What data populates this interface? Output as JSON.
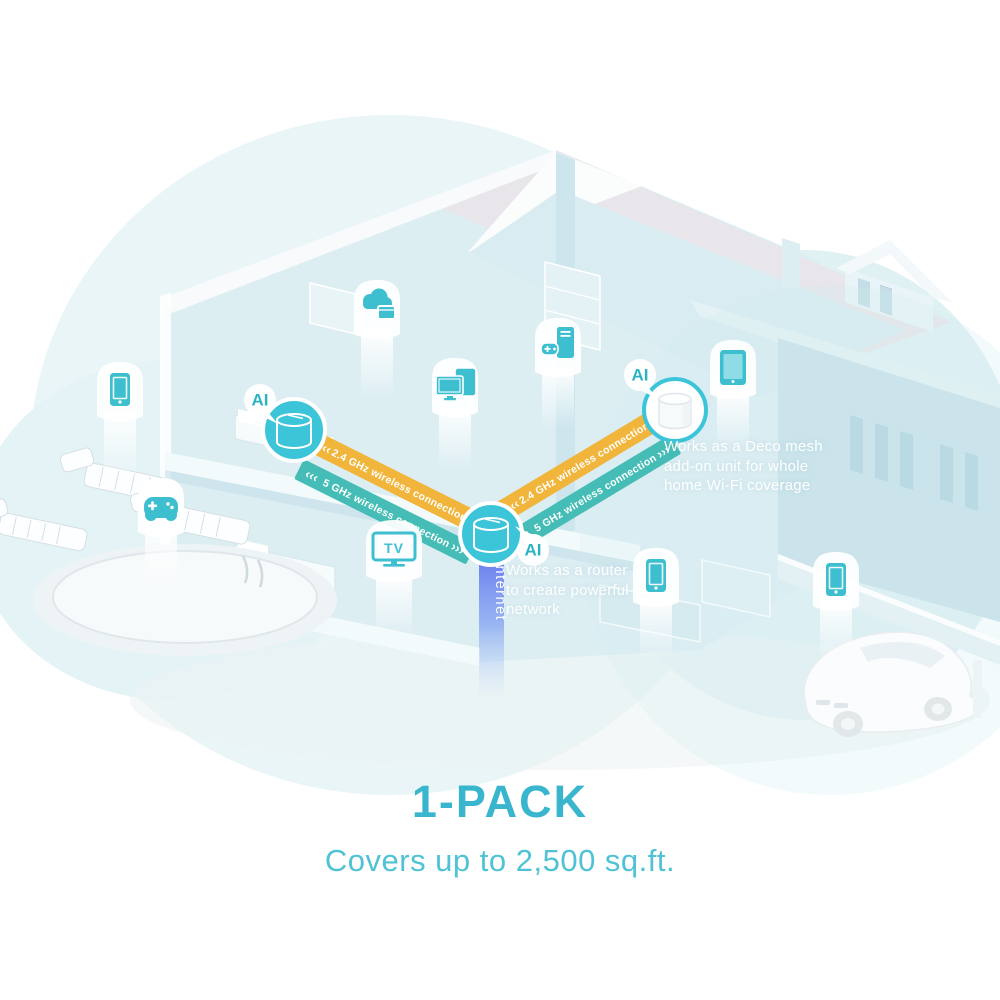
{
  "captions": {
    "pack": "1-PACK",
    "coverage": "Covers up to 2,500 sq.ft."
  },
  "labels": {
    "ai": "AI",
    "internet": "Internet",
    "tv": "TV"
  },
  "annotations": {
    "router_note": "Works as a router\nto create powerful\nnetwork",
    "mesh_note": "Works as a Deco mesh\nadd-on unit for whole\nhome Wi-Fi coverage"
  },
  "connections": {
    "left_24": "2.4 GHz wireless connection",
    "left_5": "5 GHz wireless connection",
    "right_24": "2.4 GHz wireless connection",
    "right_5": "5 GHz wireless connection",
    "chevron_in": "‹‹‹",
    "chevron_out": "›››"
  },
  "device_icons": [
    "smartphone-icon",
    "game-controller-icon",
    "cloud-storage-icon",
    "smart-screens-icon",
    "gaming-pc-icon",
    "tablet-icon",
    "smart-tv-icon",
    "smartphone-icon",
    "smartphone-icon"
  ],
  "deco_units": [
    {
      "name": "deco-unit-upstairs",
      "style": "teal"
    },
    {
      "name": "deco-unit-router",
      "style": "teal"
    },
    {
      "name": "deco-unit-mesh-addon",
      "style": "white"
    }
  ],
  "colors": {
    "accent_teal": "#3EC1D3",
    "band_yellow": "#F1B53C",
    "band_teal": "#45BDB6",
    "internet_blue_top": "#5765EC",
    "internet_blue_bottom": "#B9D4F8",
    "caption_teal": "#39B6CD",
    "ai_text_teal": "#2BB3C4"
  }
}
